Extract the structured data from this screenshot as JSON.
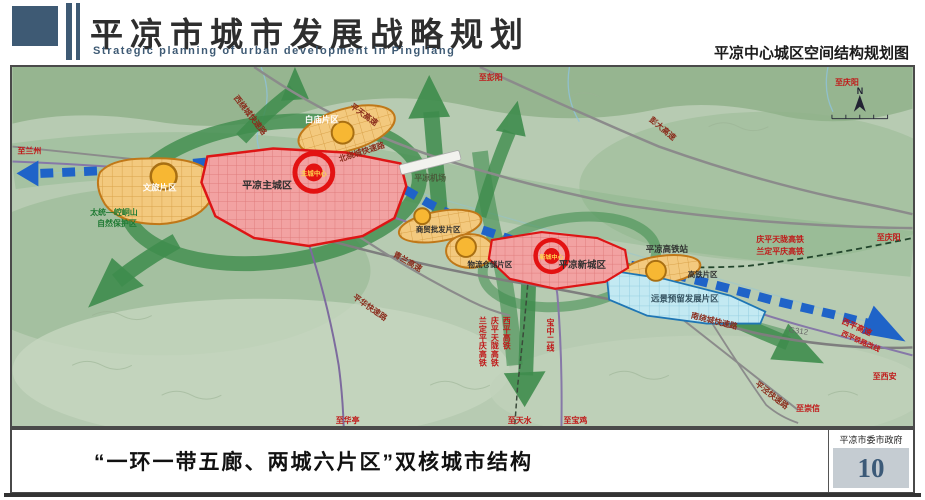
{
  "header": {
    "title": "平凉市城市发展战略规划",
    "subtitle": "Strategic planning of urban development in Pingliang",
    "right_title": "平凉中心城区空间结构规划图"
  },
  "footer": {
    "caption": "“一环一带五廊、两城六片区”双核城市结构",
    "org": "平凉市委市政府",
    "page": "10"
  },
  "map": {
    "compass": "N",
    "districts": {
      "main_city": "平凉主城区",
      "new_city": "平凉新城区",
      "wenlv": "文旅片区",
      "baimiao": "白庙片区",
      "shangmao": "商贸批发片区",
      "wuliu": "物流仓储片区",
      "gaotie_area": "高铁片区",
      "yuanjing": "远景预留发展片区"
    },
    "centers": {
      "main": "主城中心",
      "new": "新城中心"
    },
    "poi": {
      "airport": "平凉机场",
      "hsr_station": "平凉高铁站"
    },
    "nature": {
      "line1": "太统—崆峒山",
      "line2": "自然保护区"
    },
    "roads": {
      "beirao": "北绕城快速路",
      "xirao": "西绕城快速路",
      "nanrao": "南绕城快速路",
      "pinghua": "平华快速路",
      "pingjing": "平泾快速路",
      "pingtian": "平天高速",
      "pengda": "彭大高速",
      "qinglan": "青兰高速",
      "xiping_gs": "西平高速",
      "xiping_reroute": "西平铁路改线",
      "g312": "G312"
    },
    "railways": {
      "qptl": "庆平天陇高铁",
      "ldpq": "兰定平庆高铁",
      "xiping_hsr": "西平高铁",
      "baozhong2": "宝中二线"
    },
    "destinations": {
      "lanzhou": "至兰州",
      "pengyang": "至彭阳",
      "qingyang_top": "至庆阳",
      "qingyang_right": "至庆阳",
      "xian": "至西安",
      "chongxin": "至崇信",
      "huating": "至华亭",
      "tianshui": "至天水",
      "baoji": "至宝鸡"
    },
    "colors": {
      "axis_blue": "#1f63c8",
      "corridor_green": "#3e8c4c",
      "city_red": "#dd1515",
      "district_orange": "#e8a13c",
      "reserve_cyan": "#c3e9f2",
      "header_navy": "#3e5a74"
    }
  }
}
